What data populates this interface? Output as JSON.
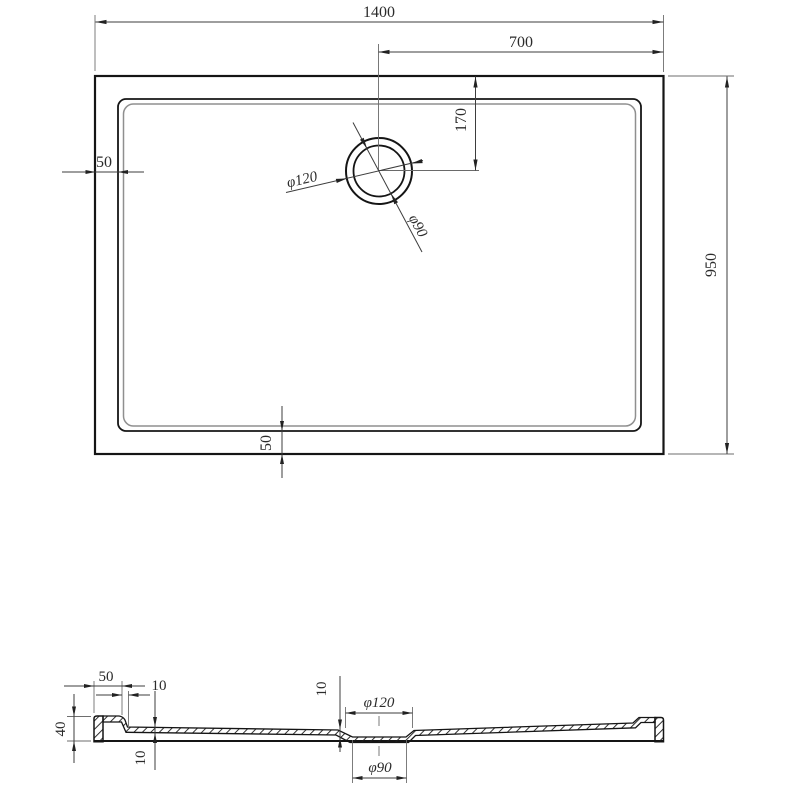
{
  "plan": {
    "width": "1400",
    "half_width": "700",
    "drain_offset": "170",
    "depth": "950",
    "rim_left": "50",
    "rim_bottom": "50",
    "drain_outer": "φ120",
    "drain_inner": "φ90"
  },
  "section": {
    "rim": "50",
    "step": "10",
    "height": "40",
    "floor_thickness": "10",
    "recess_depth": "10",
    "drain_outer": "φ120",
    "drain_inner": "φ90"
  }
}
